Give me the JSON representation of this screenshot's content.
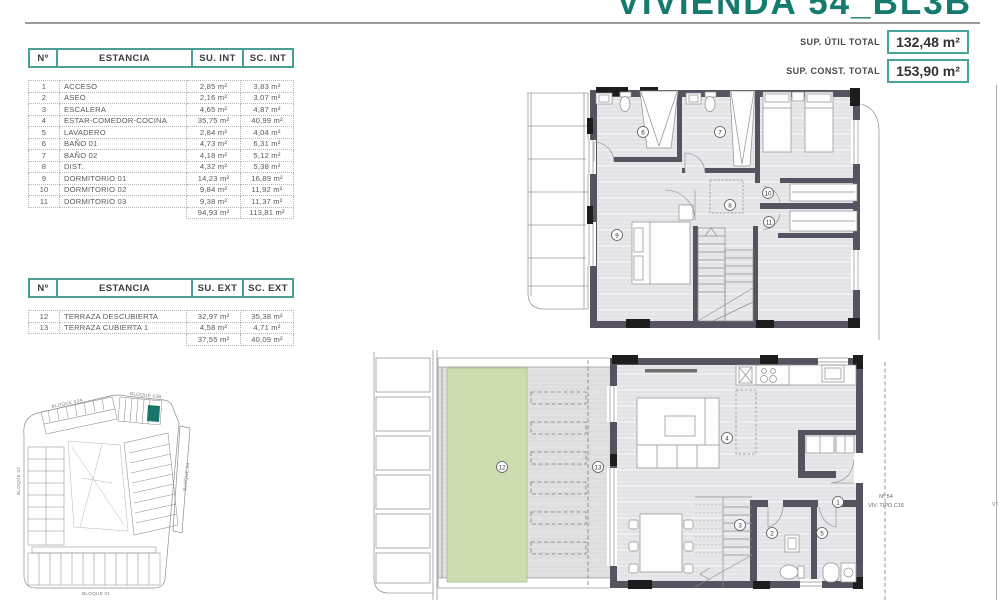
{
  "header": {
    "title": "VIVIENDA 54_BL3B",
    "sup_util_label": "SUP. ÚTIL TOTAL",
    "sup_util_value": "132,48 m²",
    "sup_const_label": "SUP. CONST. TOTAL",
    "sup_const_value": "153,90 m²"
  },
  "interior_table": {
    "headers": {
      "num": "Nº",
      "room": "ESTANCIA",
      "su": "SU. INT",
      "sc": "SC. INT"
    },
    "rows": [
      {
        "n": "1",
        "room": "ACCESO",
        "su": "2,85 m²",
        "sc": "3,83 m²"
      },
      {
        "n": "2",
        "room": "ASEO",
        "su": "2,16 m²",
        "sc": "3,07 m²"
      },
      {
        "n": "3",
        "room": "ESCALERA",
        "su": "4,65 m²",
        "sc": "4,87 m²"
      },
      {
        "n": "4",
        "room": "ESTAR-COMEDOR-COCINA",
        "su": "35,75 m²",
        "sc": "40,99 m²"
      },
      {
        "n": "5",
        "room": "LAVADERO",
        "su": "2,84 m²",
        "sc": "4,04 m²"
      },
      {
        "n": "6",
        "room": "BAÑO 01",
        "su": "4,73 m²",
        "sc": "6,31 m²"
      },
      {
        "n": "7",
        "room": "BAÑO 02",
        "su": "4,18 m²",
        "sc": "5,12 m²"
      },
      {
        "n": "8",
        "room": "DIST.",
        "su": "4,32 m²",
        "sc": "5,38 m²"
      },
      {
        "n": "9",
        "room": "DORMITORIO 01",
        "su": "14,23 m²",
        "sc": "16,89 m²"
      },
      {
        "n": "10",
        "room": "DORMITORIO 02",
        "su": "9,84 m²",
        "sc": "11,92 m²"
      },
      {
        "n": "11",
        "room": "DORMITORIO 03",
        "su": "9,38 m²",
        "sc": "11,37 m²"
      }
    ],
    "total_su": "94,93 m²",
    "total_sc": "113,81 m²"
  },
  "exterior_table": {
    "headers": {
      "num": "Nº",
      "room": "ESTANCIA",
      "su": "SU. EXT",
      "sc": "SC. EXT"
    },
    "rows": [
      {
        "n": "12",
        "room": "TERRAZA DESCUBIERTA",
        "su": "32,97 m²",
        "sc": "35,38 m²"
      },
      {
        "n": "13",
        "room": "TERRAZA CUBIERTA 1",
        "su": "4,58 m²",
        "sc": "4,71 m²"
      }
    ],
    "total_su": "37,55 m²",
    "total_sc": "40,09 m²"
  },
  "site_plan": {
    "labels": [
      "BLOQUE 03A",
      "BLOQUE 03B",
      "BLOQUE 02",
      "BLOQUE 04",
      "BLOQUE 01"
    ],
    "highlight_color": "#17756a"
  },
  "plans": {
    "upper": {
      "room_numbers": [
        "6",
        "7",
        "8",
        "9",
        "10",
        "11"
      ]
    },
    "lower": {
      "room_numbers": [
        "1",
        "2",
        "3",
        "4",
        "5",
        "12",
        "13"
      ],
      "unit_line1": "Nº 54",
      "unit_line2": "VIV. TIPO C16",
      "edge_label": "VT"
    }
  },
  "colors": {
    "accent_teal": "#177a6e",
    "table_border_teal": "#4aa095",
    "wall": "#575260",
    "terrace_green": "#cedcb2"
  }
}
